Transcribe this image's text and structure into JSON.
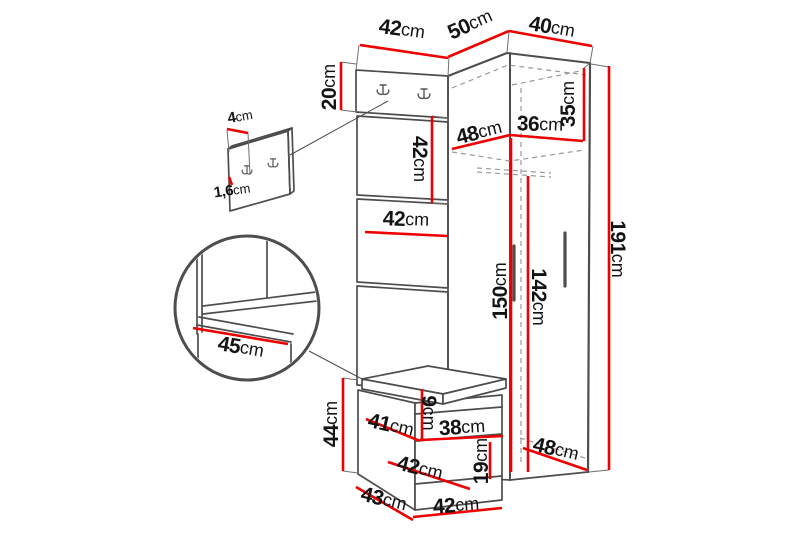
{
  "diagram": {
    "kind": "hallway-furniture-dimension-diagram",
    "unit_suffix": "cm",
    "colors": {
      "background": "#ffffff",
      "dimension_line": "#ee0000",
      "structure_line": "#4d4d4d",
      "hidden_line": "#9a9a9a",
      "extension_line": "#6f6f6f",
      "text": "#141414"
    },
    "dims": {
      "d4": {
        "v": "4",
        "u": "cm"
      },
      "d16": {
        "v": "1,6",
        "u": "cm"
      },
      "d20": {
        "v": "20",
        "u": "cm"
      },
      "d42top": {
        "v": "42",
        "u": "cm"
      },
      "d50": {
        "v": "50",
        "u": "cm"
      },
      "d40": {
        "v": "40",
        "u": "cm"
      },
      "d35": {
        "v": "35",
        "u": "cm"
      },
      "d48up": {
        "v": "48",
        "u": "cm"
      },
      "d36": {
        "v": "36",
        "u": "cm"
      },
      "d42vert": {
        "v": "42",
        "u": "cm"
      },
      "d42mid": {
        "v": "42",
        "u": "cm"
      },
      "d191": {
        "v": "191",
        "u": "cm"
      },
      "d150": {
        "v": "150",
        "u": "cm"
      },
      "d142": {
        "v": "142",
        "u": "cm"
      },
      "d45": {
        "v": "45",
        "u": "cm"
      },
      "d44": {
        "v": "44",
        "u": "cm"
      },
      "d41": {
        "v": "41",
        "u": "cm"
      },
      "d9": {
        "v": "9",
        "u": "cm"
      },
      "d38": {
        "v": "38",
        "u": "cm"
      },
      "d19": {
        "v": "19",
        "u": "cm"
      },
      "d42low": {
        "v": "42",
        "u": "cm"
      },
      "d43": {
        "v": "43",
        "u": "cm"
      },
      "d42bot": {
        "v": "42",
        "u": "cm"
      },
      "d48low": {
        "v": "48",
        "u": "cm"
      }
    }
  }
}
